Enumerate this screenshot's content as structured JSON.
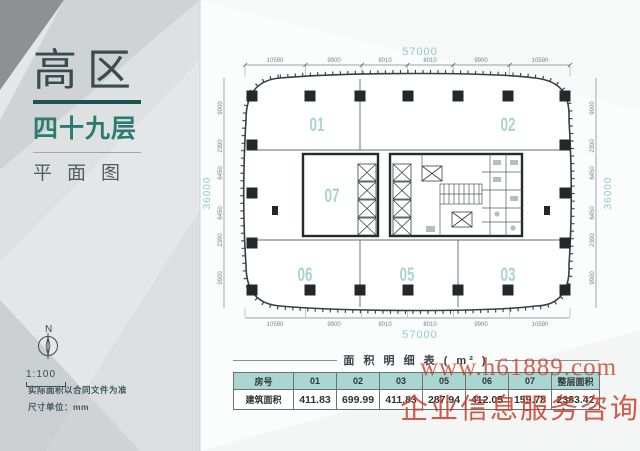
{
  "sidebar": {
    "zone_label": "高区",
    "floor_label": "四十九层",
    "type_label": "平面图",
    "compass_n": "N",
    "scale_label": "1:100",
    "note1": "实际面积以合同文件为准",
    "note2": "尺寸单位：mm"
  },
  "plan": {
    "width_total": "57000",
    "height_total": "36000",
    "top_dims": [
      "10590",
      "9900",
      "8010",
      "8010",
      "9900",
      "10590"
    ],
    "bottom_dims": [
      "10590",
      "9900",
      "8010",
      "8010",
      "9900",
      "10590"
    ],
    "left_dims": [
      "9900",
      "2390",
      "6450",
      "6450",
      "2390",
      "9900"
    ],
    "right_dims": [
      "9900",
      "2390",
      "6450",
      "6450",
      "2390",
      "9900"
    ],
    "unit_labels": [
      "01",
      "02",
      "07",
      "06",
      "05",
      "03"
    ]
  },
  "table": {
    "title": "面 积 明 细 表 ( m² )",
    "headers": [
      "房号",
      "01",
      "02",
      "03",
      "05",
      "06",
      "07",
      "整层面积"
    ],
    "row_label": "建筑面积",
    "values": [
      "411.83",
      "699.99",
      "411.83",
      "287.94",
      "412.05",
      "159.78",
      "2383.42"
    ]
  },
  "watermark": {
    "line1": "www.h61889.com",
    "line2": "企业信息服务咨询"
  },
  "colors": {
    "accent_teal": "#2d7a72",
    "light_teal": "#a9d5cf",
    "table_header_bg": "#a9d6d1",
    "rule_dark": "#1d5153",
    "watermark_red": "#c93e2c",
    "panel_gray": "#e4e6e8"
  }
}
